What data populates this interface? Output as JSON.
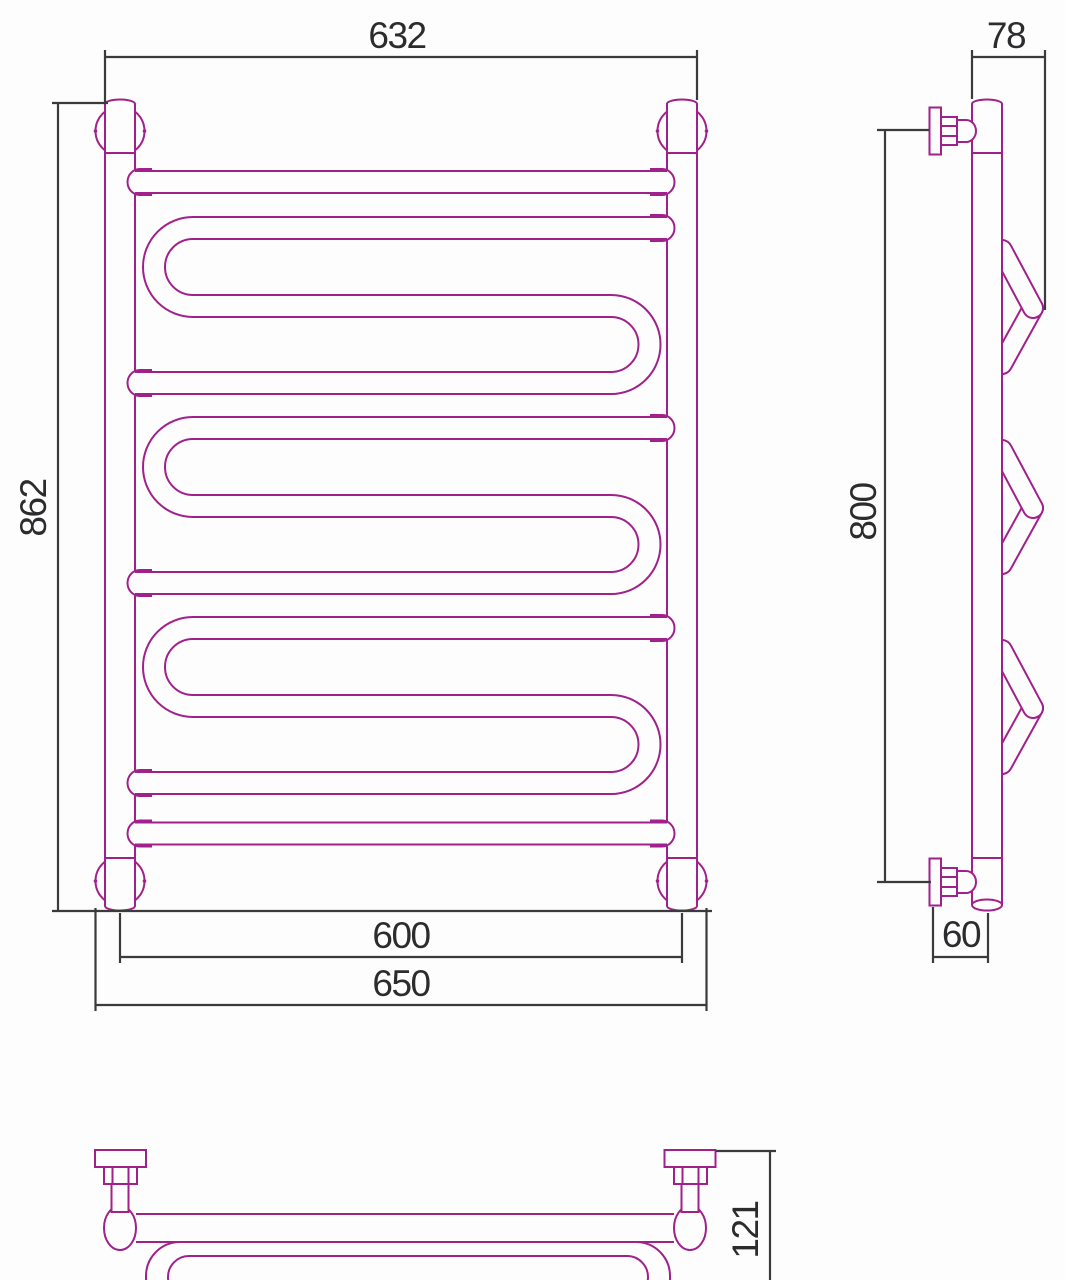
{
  "drawing": {
    "type": "technical-dimension-drawing",
    "subject": "ladder-style heated towel rail with serpentine coils",
    "colors": {
      "product_outline": "#a0208c",
      "dimension_lines": "#3b3b3d",
      "label_text": "#2c2c2e",
      "background": "#fdfdfd"
    },
    "views": {
      "front": {
        "dimensions": {
          "outer_width": "632",
          "overall_height": "862",
          "axis_width": "600",
          "bracket_width": "650"
        }
      },
      "side": {
        "dimensions": {
          "hook_depth": "78",
          "mount_height": "800",
          "wall_offset": "60"
        }
      },
      "top": {
        "dimensions": {
          "overall_depth": "121"
        }
      }
    }
  }
}
